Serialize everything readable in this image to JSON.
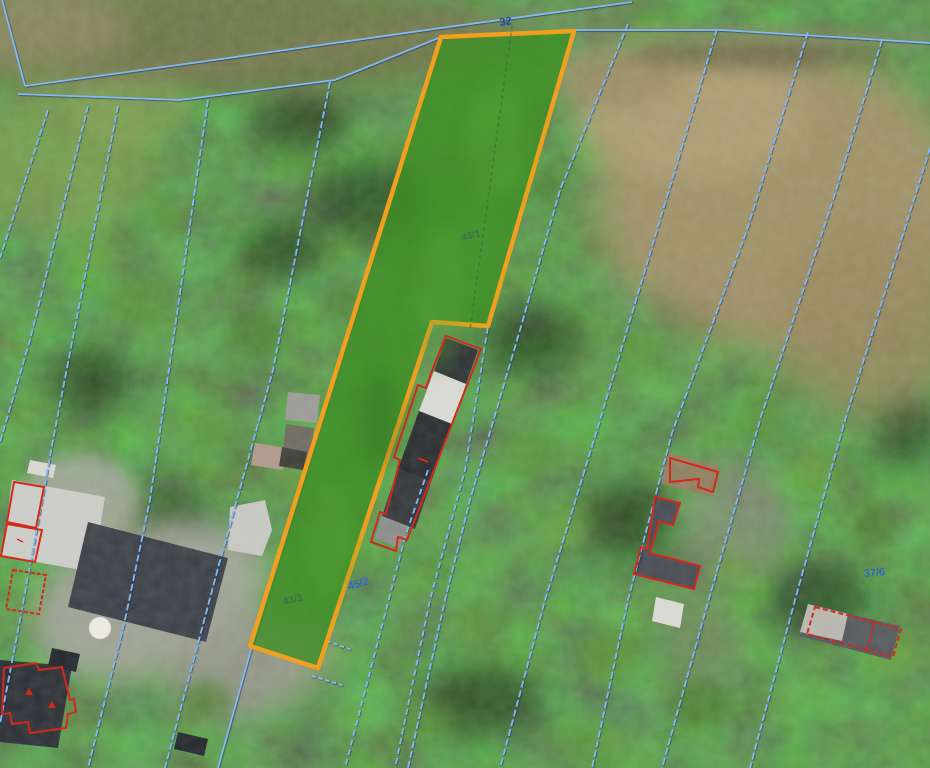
{
  "map": {
    "title": "cadastral-orthophoto-view",
    "labels": {
      "road": {
        "text": "32"
      },
      "parcel_top": {
        "text": "43/1"
      },
      "parcel_bottom": {
        "text": "43/3"
      },
      "neighbor": {
        "text": "45/2"
      },
      "right": {
        "text": "37/6"
      }
    },
    "colors": {
      "boundary_blue": "#86b9ef",
      "highlight_fill": "#3f8f26",
      "highlight_stroke": "#f0a01e",
      "building_red": "#d3291a",
      "label_blue": "#3563c9",
      "label_navy": "#23479e",
      "label_dim": "#3d6b50"
    }
  }
}
